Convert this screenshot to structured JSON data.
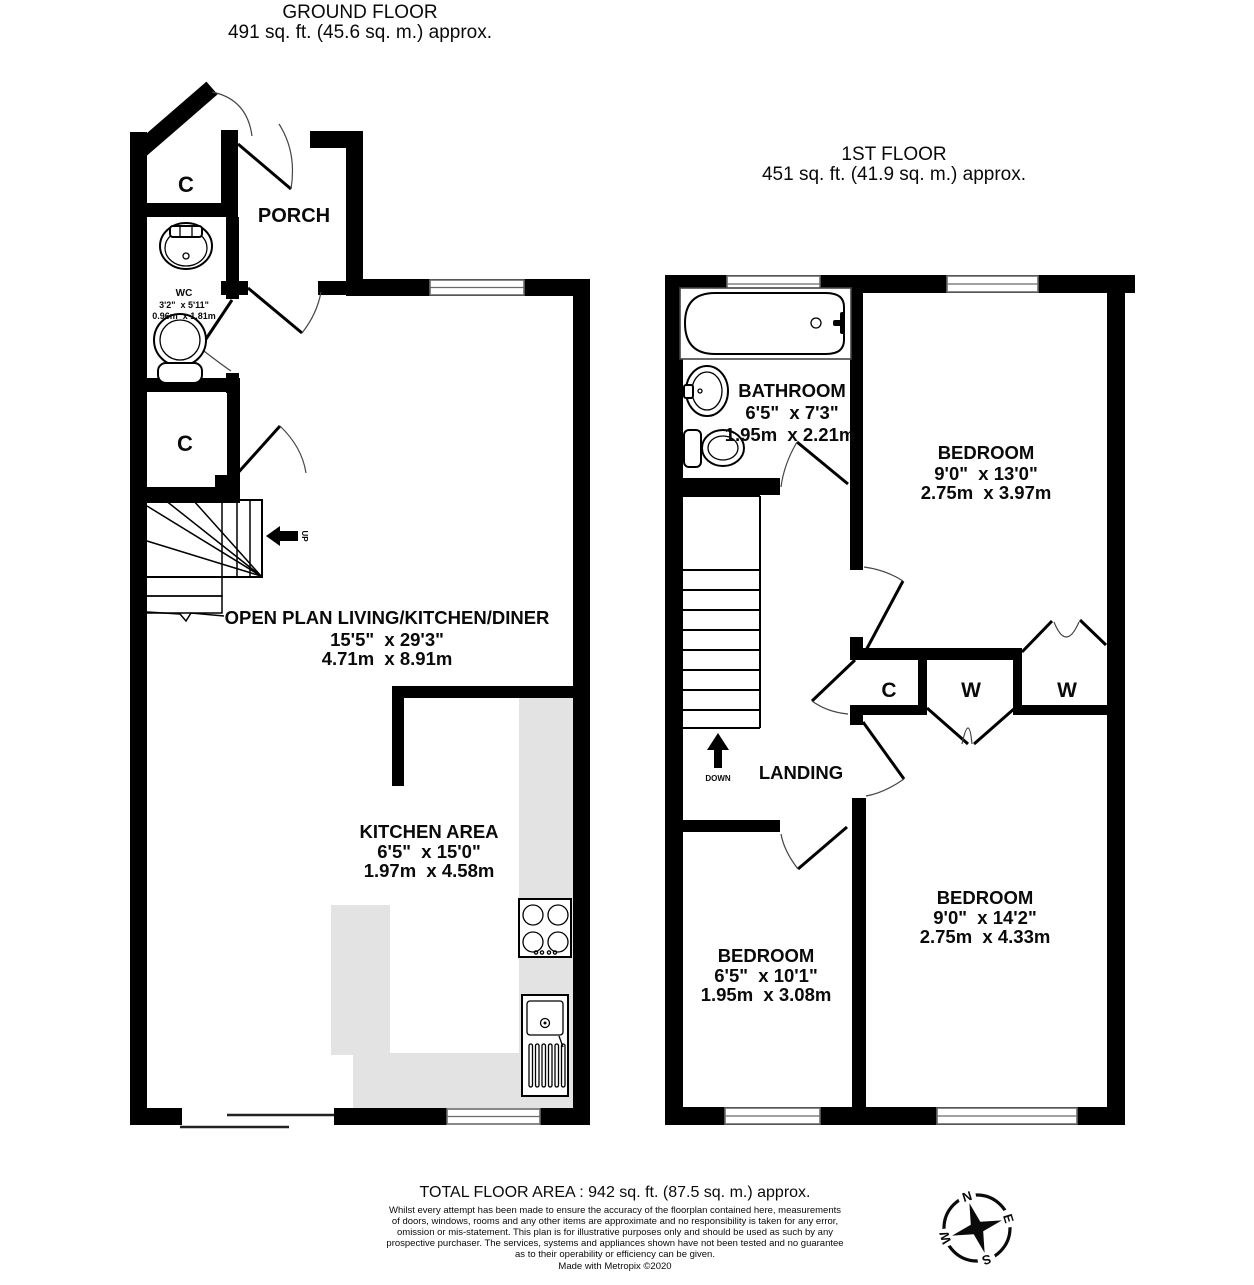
{
  "ground_floor": {
    "title": "GROUND FLOOR",
    "area": "491 sq. ft. (45.6 sq. m.) approx.",
    "cupboard_top": "C",
    "porch": "PORCH",
    "wc": {
      "name": "WC",
      "imperial": "3'2\"  x 5'11\"",
      "metric": "0.96m  x 1.81m"
    },
    "cupboard_mid": "C",
    "stairs_label": "UP",
    "living": {
      "name": "OPEN PLAN LIVING/KITCHEN/DINER",
      "imperial": "15'5\"  x 29'3\"",
      "metric": "4.71m  x 8.91m"
    },
    "kitchen": {
      "name": "KITCHEN AREA",
      "imperial": "6'5\"  x 15'0\"",
      "metric": "1.97m  x 4.58m"
    }
  },
  "first_floor": {
    "title": "1ST FLOOR",
    "area": "451 sq. ft. (41.9 sq. m.) approx.",
    "bathroom": {
      "name": "BATHROOM",
      "imperial": "6'5\"  x 7'3\"",
      "metric": "1.95m  x 2.21m"
    },
    "bedroom_top": {
      "name": "BEDROOM",
      "imperial": "9'0\"  x 13'0\"",
      "metric": "2.75m  x 3.97m"
    },
    "landing": "LANDING",
    "stairs_label": "DOWN",
    "cupboard": "C",
    "wardrobe_left": "W",
    "wardrobe_right": "W",
    "bedroom_left": {
      "name": "BEDROOM",
      "imperial": "6'5\"  x 10'1\"",
      "metric": "1.95m  x 3.08m"
    },
    "bedroom_right": {
      "name": "BEDROOM",
      "imperial": "9'0\"  x 14'2\"",
      "metric": "2.75m  x 4.33m"
    }
  },
  "footer": {
    "total": "TOTAL FLOOR AREA : 942 sq. ft. (87.5 sq. m.) approx.",
    "disclaimer_lines": [
      "Whilst every attempt has been made to ensure the accuracy of the floorplan contained here, measurements",
      "of doors, windows, rooms and any other items are approximate and no responsibility is taken for any error,",
      "omission or mis-statement. This plan is for illustrative purposes only and should be used as such by any",
      "prospective purchaser. The services, systems and appliances shown have not been tested and no guarantee",
      "as to their operability or efficiency can be given.",
      "Made with Metropix ©2020"
    ]
  },
  "compass": {
    "n": "N",
    "e": "E",
    "s": "S",
    "w": "W"
  },
  "colors": {
    "wall": "#000000",
    "counter": "#e3e3e3",
    "text": "#0a0a0a"
  }
}
